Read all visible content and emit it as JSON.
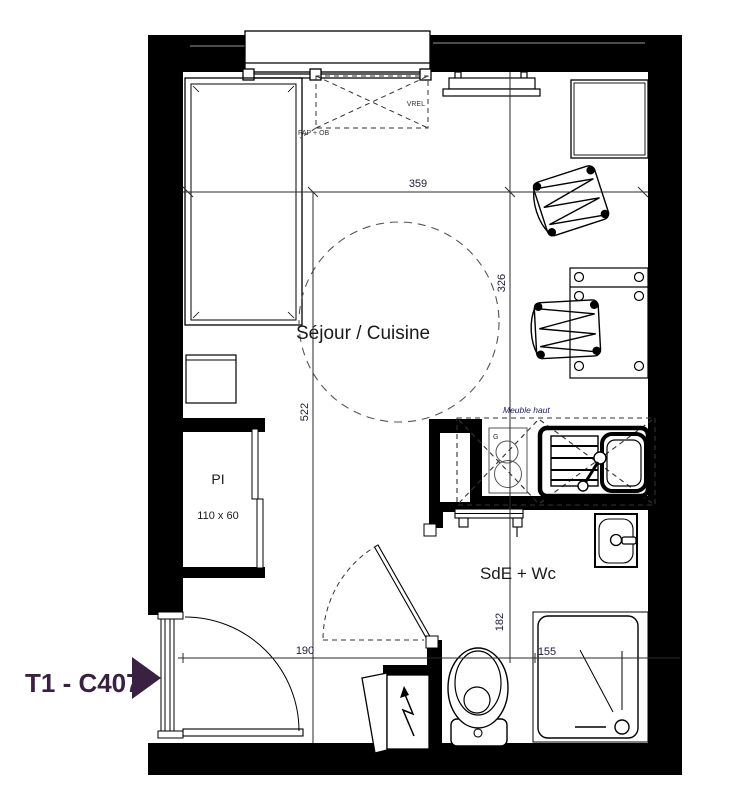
{
  "unit": {
    "label": "T1 - C407",
    "color": "#3A2142"
  },
  "rooms": {
    "living_kitchen": "Séjour / Cuisine",
    "bathroom": "SdE + Wc",
    "closet": "PI",
    "closet_size": "110 x 60"
  },
  "annotations": {
    "upper_cabinet": "Meuble haut",
    "shutter": "VREL",
    "vent": "FAP + OB",
    "cooktop_mark": "G"
  },
  "dimensions": {
    "top_width": "359",
    "right_height": "326",
    "left_height": "522",
    "entrance_width": "190",
    "bath_height": "182",
    "shower_width": "155"
  }
}
